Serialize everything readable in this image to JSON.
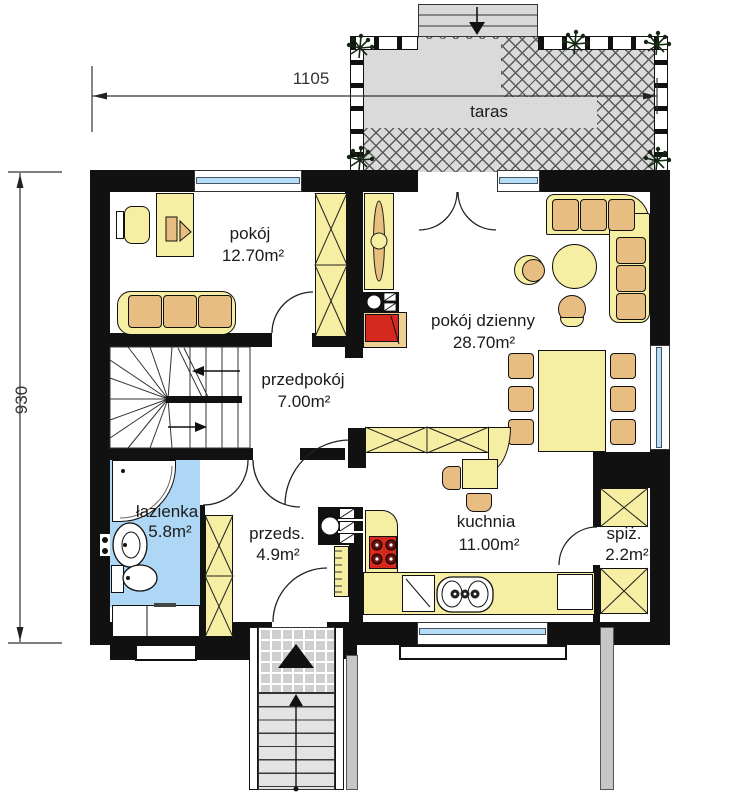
{
  "plan_title": "parter (ground floor) plan",
  "dimensions": {
    "top": "1105",
    "left": "930"
  },
  "rooms": {
    "pokoj": {
      "label": "pokój",
      "area": "12.70m²"
    },
    "pokoj_dzienny": {
      "label": "pokój dzienny",
      "area": "28.70m²"
    },
    "przedpokoj": {
      "label": "przedpokój",
      "area": "7.00m²"
    },
    "lazienka": {
      "label": "łazienka",
      "area": "5.8m²"
    },
    "przeds": {
      "label": "przeds.",
      "area": "4.9m²"
    },
    "kuchnia": {
      "label": "kuchnia",
      "area": "11.00m²"
    },
    "spiz": {
      "label": "spiż.",
      "area": "2.2m²"
    },
    "taras": {
      "label": "taras",
      "area": ""
    }
  },
  "colors": {
    "wall": "#111111",
    "furniture": "#f6eea2",
    "cushion": "#e7bd81",
    "bath_floor": "#aed6f5",
    "terrace": "#dadada",
    "accent_red": "#d5281e",
    "window_glass": "#b5ddf5"
  }
}
